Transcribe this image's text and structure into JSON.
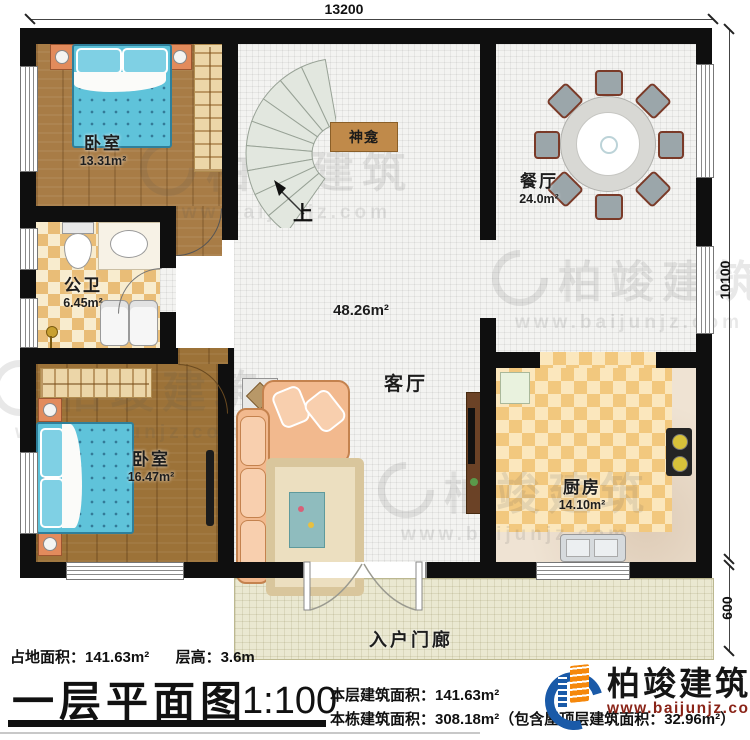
{
  "dimensions": {
    "top_width": "13200",
    "right_height": "10100",
    "porch_depth": "600"
  },
  "rooms": {
    "bedroom1": {
      "name": "卧室",
      "area": "13.31m²"
    },
    "dining": {
      "name": "餐厅",
      "area": "24.0m²"
    },
    "bathroom": {
      "name": "公卫",
      "area": "6.45m²"
    },
    "living": {
      "name": "客厅",
      "area": "48.26m²"
    },
    "bedroom2": {
      "name": "卧室",
      "area": "16.47m²"
    },
    "kitchen": {
      "name": "厨房",
      "area": "14.10m²"
    },
    "porch": {
      "name": "入户门廊"
    },
    "shrine": {
      "name": "神龛"
    },
    "stairs": {
      "up_label": "上"
    }
  },
  "footer": {
    "site_area": "占地面积：141.63m²",
    "floor_height": "层高：3.6m",
    "plan_title": "一层平面图",
    "scale": "1:100",
    "floor_area": "本层建筑面积：141.63m²",
    "total_area": "本栋建筑面积：308.18m²（包含屋顶层建筑面积：32.96m²）"
  },
  "brand": {
    "name": "柏竣建筑",
    "url": "www.baijunjz.com"
  },
  "watermark": {
    "name": "柏竣建筑",
    "url": "www.baijunjz.com"
  },
  "colors": {
    "wall": "#0f0f0f",
    "wood_floor": "#a87c46",
    "tile_floor": "#f3f3f1",
    "bath_checker": "#e9bd77",
    "kitchen_checker": "#f2c87e",
    "porch_floor": "#eae8d1",
    "bed_blue": "#5fc3da",
    "brand_blue": "#1a5aa8",
    "brand_orange": "#f5880c",
    "brand_url_red": "#8a2418"
  }
}
